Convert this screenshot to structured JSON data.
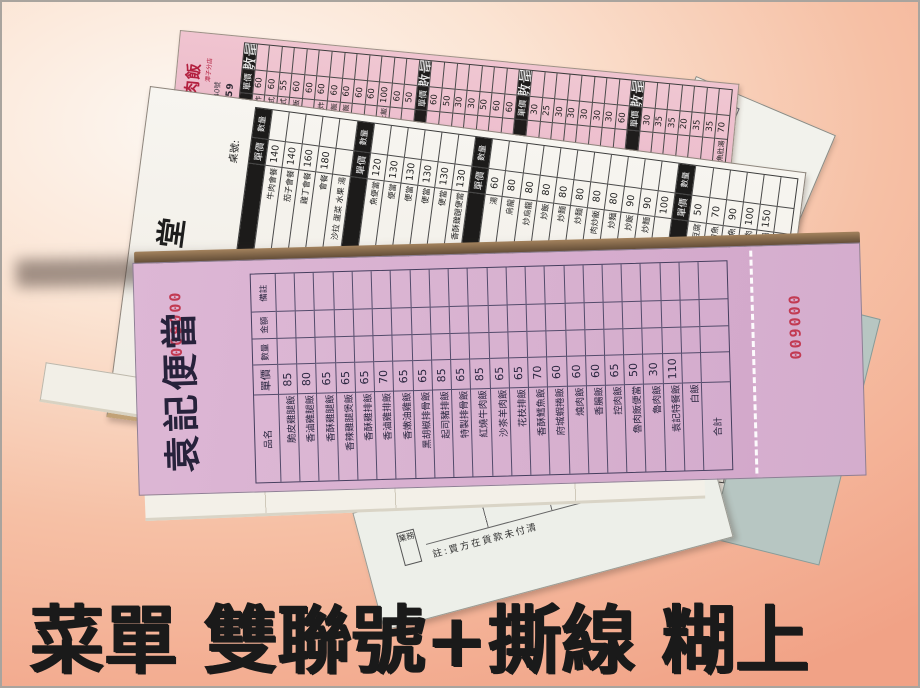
{
  "caption": {
    "text": "菜單 雙聯號+撕線 糊上"
  },
  "colors": {
    "background_salmon": "#f2a68a",
    "caption_black": "#1a1a1a",
    "front_sheet_pink": "#d5abce",
    "top_sheet_pink": "#ecc0cf",
    "serial_red": "#c23a52",
    "paper_white": "#f5f3ec",
    "board_brown": "#8a6c4e"
  },
  "front_pad": {
    "title": "袁記便當",
    "serial_main": "009000",
    "serial_stub": "009000",
    "headers": {
      "note": "備註",
      "amount": "金額",
      "qty": "數量",
      "price": "單價",
      "name": "品名",
      "total": "合計"
    },
    "items": [
      {
        "name": "脆皮雞腿飯",
        "price": "85"
      },
      {
        "name": "香滷雞腿飯",
        "price": "80"
      },
      {
        "name": "香酥雞腿飯",
        "price": "65"
      },
      {
        "name": "香辣雞腿煲飯",
        "price": "65"
      },
      {
        "name": "香酥雞排飯",
        "price": "65"
      },
      {
        "name": "香滷雞排飯",
        "price": "70"
      },
      {
        "name": "香嫩油雞飯",
        "price": "65"
      },
      {
        "name": "黑胡椒排骨飯",
        "price": "65"
      },
      {
        "name": "起司豬排飯",
        "price": "85"
      },
      {
        "name": "特製排骨飯",
        "price": "65"
      },
      {
        "name": "紅燒牛肉飯",
        "price": "85"
      },
      {
        "name": "沙茶羊肉飯",
        "price": "65"
      },
      {
        "name": "花枝排飯",
        "price": "65"
      },
      {
        "name": "香酥鱈魚飯",
        "price": "70"
      },
      {
        "name": "府城蝦捲飯",
        "price": "60"
      },
      {
        "name": "燒肉飯",
        "price": "60"
      },
      {
        "name": "香腸飯",
        "price": "60"
      },
      {
        "name": "控肉飯",
        "price": "65"
      },
      {
        "name": "魯肉飯便當",
        "price": "50"
      },
      {
        "name": "魯肉飯",
        "price": "30"
      },
      {
        "name": "袁記特餐飯",
        "price": "110"
      },
      {
        "name": "白飯",
        "price": ""
      }
    ]
  },
  "top_pad": {
    "title": "台灣火雞肉飯",
    "branch": "潭子分店",
    "address": "市潭子區圓環一路340號",
    "phone": "04-25312659",
    "header_qty": "數量",
    "header_price": "單價",
    "columns": [
      {
        "type": "header"
      },
      {
        "price": "60",
        "name": "魯,炸"
      },
      {
        "price": "60",
        "name": "中式"
      },
      {
        "price": "55",
        "name": "日式"
      },
      {
        "price": "60",
        "name": "飯"
      },
      {
        "price": "60",
        "name": ""
      },
      {
        "price": "60",
        "name": "魯,炸"
      },
      {
        "price": "60",
        "name": "肉飯"
      },
      {
        "price": "60",
        "name": "飯"
      },
      {
        "price": "60",
        "name": ""
      },
      {
        "price": "60",
        "name": ""
      },
      {
        "price": "100",
        "name": "虱目魚肚飯"
      },
      {
        "price": "60",
        "name": ""
      },
      {
        "price": "50",
        "name": ""
      },
      {
        "type": "header"
      },
      {
        "price": "60",
        "name": ""
      },
      {
        "price": "50",
        "name": ""
      },
      {
        "price": "30",
        "name": ""
      },
      {
        "price": "30",
        "name": ""
      },
      {
        "price": "50",
        "name": ""
      },
      {
        "price": "60",
        "name": ""
      },
      {
        "price": "60",
        "name": ""
      },
      {
        "type": "header"
      },
      {
        "price": "30",
        "name": ""
      },
      {
        "price": "25",
        "name": ""
      },
      {
        "price": "30",
        "name": ""
      },
      {
        "price": "30",
        "name": ""
      },
      {
        "price": "30",
        "name": ""
      },
      {
        "price": "30",
        "name": ""
      },
      {
        "price": "30",
        "name": ""
      },
      {
        "price": "60",
        "name": ""
      },
      {
        "type": "header"
      },
      {
        "price": "30",
        "name": ""
      },
      {
        "price": "35",
        "name": ""
      },
      {
        "price": "35",
        "name": ""
      },
      {
        "price": "20",
        "name": ""
      },
      {
        "price": "35",
        "name": ""
      },
      {
        "price": "35",
        "name": ""
      },
      {
        "price": "70",
        "name": "無刺虱目魚肚湯"
      }
    ]
  },
  "middle_pad": {
    "title": "大八食堂",
    "table_no_label": "桌號:",
    "header_qty": "數量",
    "header_price": "單價",
    "sections": [
      {
        "items": [
          {
            "price": "140",
            "name": "牛肉會餐"
          },
          {
            "price": "140",
            "name": "茄子會餐"
          },
          {
            "price": "160",
            "name": "雞丁會餐"
          },
          {
            "price": "180",
            "name": "會餐"
          },
          {
            "price": "",
            "name": "沙拉 蛋菜 水果 湯"
          }
        ]
      },
      {
        "items": [
          {
            "price": "120",
            "name": "魚便當"
          },
          {
            "price": "130",
            "name": "便當"
          },
          {
            "price": "130",
            "name": "便當"
          },
          {
            "price": "130",
            "name": "便當"
          },
          {
            "price": "130",
            "name": "便當"
          },
          {
            "price": "130",
            "name": "香酥雞腿便當"
          }
        ]
      },
      {
        "items": [
          {
            "price": "60",
            "name": "湯"
          },
          {
            "price": "80",
            "name": "烏龍"
          },
          {
            "price": "80",
            "name": "炒烏龍"
          },
          {
            "price": "80",
            "name": "炒飯"
          },
          {
            "price": "80",
            "name": "炒麵"
          },
          {
            "price": "80",
            "name": "炒麵"
          },
          {
            "price": "80",
            "name": "肉炒飯"
          },
          {
            "price": "80",
            "name": "炒麵"
          },
          {
            "price": "90",
            "name": "炒飯"
          },
          {
            "price": "90",
            "name": "炒麵"
          },
          {
            "price": "100",
            "name": ""
          }
        ]
      },
      {
        "items": [
          {
            "price": "50",
            "name": "臭豆腐"
          },
          {
            "price": "70",
            "name": "刀魚"
          },
          {
            "price": "90",
            "name": "水煮魚"
          },
          {
            "price": "100",
            "name": "麻辣豬肉"
          },
          {
            "price": "150",
            "name": "鍋"
          },
          {
            "price": "",
            "name": "$:"
          }
        ]
      }
    ]
  },
  "right_sheet": {
    "price_label": "價",
    "amount_label": "金額"
  },
  "bottom_sheet": {
    "note": "註:買方在貨款未付清",
    "stamp_box": "業務"
  }
}
